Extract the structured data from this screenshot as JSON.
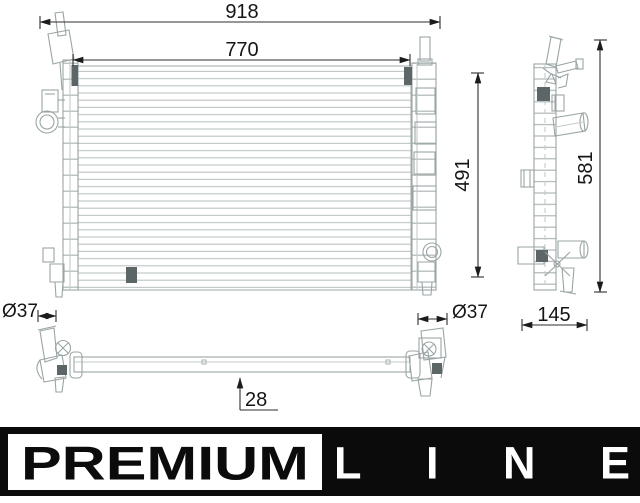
{
  "dimensions": {
    "overall_width": "918",
    "core_width": "770",
    "core_height": "491",
    "overall_height": "581",
    "depth": "145",
    "left_port_diameter": "Ø37",
    "right_port_diameter": "Ø37",
    "bottom_tube_width": "28"
  },
  "logo": {
    "premium": "PREMIUM",
    "line": "LINE"
  },
  "colors": {
    "line_art": "#9aa4a4",
    "fin_lines": "#bcc4c4",
    "dimension_lines": "#2e2e2e",
    "dark_detail": "#5d6666",
    "logo_background": "#0b0b0b",
    "logo_panel": "#ffffff"
  }
}
